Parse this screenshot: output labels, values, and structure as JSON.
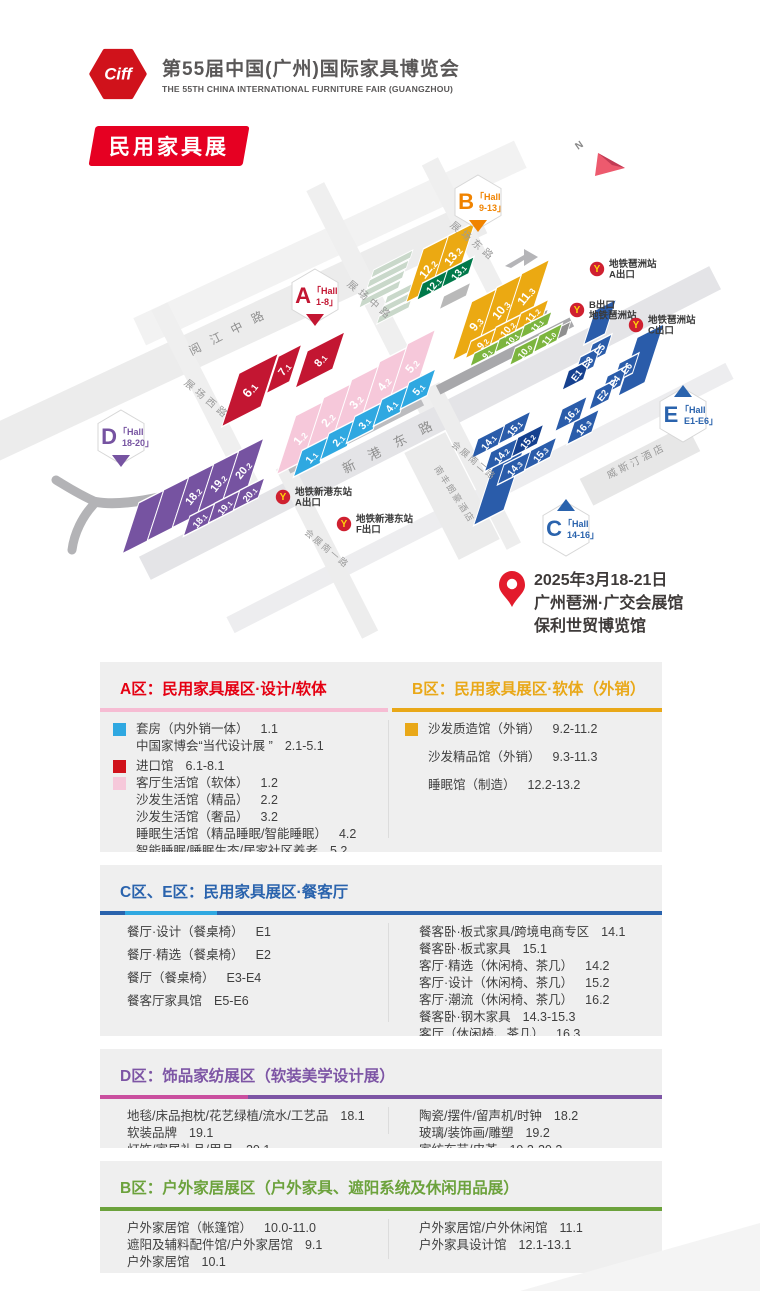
{
  "header": {
    "logo_text": "Ciff",
    "title": "第55届中国(广州)国际家具博览会",
    "subtitle": "THE 55TH CHINA INTERNATIONAL FURNITURE FAIR (GUANGZHOU)"
  },
  "badge": {
    "label": "民用家具展"
  },
  "date_block": {
    "line1": "2025年3月18-21日",
    "line2": "广州琶洲·广交会展馆",
    "line3": "保利世贸博览馆"
  },
  "map": {
    "north_label": "N",
    "roads": [
      {
        "x": 235,
        "y": 193,
        "len": 540,
        "w": 36,
        "angle": -25,
        "color": "#ececec"
      },
      {
        "x": 330,
        "y": 105,
        "len": 420,
        "w": 30,
        "angle": -25,
        "color": "#f2f2f2"
      },
      {
        "x": 430,
        "y": 285,
        "len": 640,
        "w": 26,
        "angle": -27,
        "color": "#e4e4e7"
      },
      {
        "x": 480,
        "y": 360,
        "len": 560,
        "w": 18,
        "angle": -27,
        "color": "#ededef"
      },
      {
        "x": 372,
        "y": 160,
        "len": 250,
        "w": 20,
        "angle": 63,
        "color": "#efefef"
      },
      {
        "x": 207,
        "y": 262,
        "len": 210,
        "w": 18,
        "angle": 63,
        "color": "#efefef"
      },
      {
        "x": 473,
        "y": 108,
        "len": 190,
        "w": 18,
        "angle": 63,
        "color": "#efefef"
      },
      {
        "x": 327,
        "y": 412,
        "len": 190,
        "w": 18,
        "angle": 63,
        "color": "#ededed"
      },
      {
        "x": 473,
        "y": 328,
        "len": 180,
        "w": 16,
        "angle": 63,
        "color": "#ededed"
      },
      {
        "x": 640,
        "y": 327,
        "len": 120,
        "w": 30,
        "angle": -27,
        "color": "#e7e7e7"
      },
      {
        "x": 452,
        "y": 358,
        "len": 120,
        "w": 46,
        "angle": 63,
        "color": "#ebebeb"
      },
      {
        "x": 505,
        "y": 218,
        "len": 150,
        "w": 10,
        "angle": -27,
        "color": "#a8a8ab"
      },
      {
        "x": 355,
        "y": 297,
        "len": 150,
        "w": 10,
        "angle": -27,
        "color": "#bcbcbf"
      }
    ],
    "decor": [
      {
        "x": 392,
        "y": 126,
        "w": 44,
        "h": 6,
        "c": "#c9d8ca"
      },
      {
        "x": 388,
        "y": 136,
        "w": 44,
        "h": 6,
        "c": "#c9d8ca"
      },
      {
        "x": 384,
        "y": 146,
        "w": 44,
        "h": 6,
        "c": "#c9d8ca"
      },
      {
        "x": 380,
        "y": 156,
        "w": 44,
        "h": 6,
        "c": "#c9d8ca"
      },
      {
        "x": 402,
        "y": 154,
        "w": 36,
        "h": 6,
        "c": "#c9d8ca"
      },
      {
        "x": 398,
        "y": 164,
        "w": 36,
        "h": 6,
        "c": "#c9d8ca"
      },
      {
        "x": 394,
        "y": 174,
        "w": 36,
        "h": 6,
        "c": "#c9d8ca"
      },
      {
        "x": 455,
        "y": 158,
        "w": 30,
        "h": 10,
        "c": "#b9b9b9"
      },
      {
        "x": 530,
        "y": 186,
        "w": 36,
        "h": 10,
        "c": "#9f9f9f"
      },
      {
        "x": 557,
        "y": 196,
        "w": 26,
        "h": 10,
        "c": "#8f8f8f"
      }
    ],
    "blocks": [
      {
        "l": "6.1",
        "x": 250,
        "y": 252,
        "w": 44,
        "h": 40,
        "c": "#c31632",
        "fs": 13
      },
      {
        "l": "7.1",
        "x": 284,
        "y": 231,
        "w": 26,
        "h": 28,
        "c": "#c31632",
        "fs": 11
      },
      {
        "l": "8.1",
        "x": 320,
        "y": 222,
        "w": 42,
        "h": 28,
        "c": "#c31632",
        "fs": 11
      },
      {
        "l": "1.2",
        "x": 300,
        "y": 300,
        "w": 31,
        "h": 44,
        "c": "#f6c8da",
        "fs": 12
      },
      {
        "l": "2.2",
        "x": 328,
        "y": 282,
        "w": 31,
        "h": 44,
        "c": "#f6c8da",
        "fs": 12
      },
      {
        "l": "3.2",
        "x": 356,
        "y": 264,
        "w": 31,
        "h": 44,
        "c": "#f6c8da",
        "fs": 12
      },
      {
        "l": "4.2",
        "x": 384,
        "y": 246,
        "w": 31,
        "h": 44,
        "c": "#f6c8da",
        "fs": 12
      },
      {
        "l": "5.2",
        "x": 412,
        "y": 228,
        "w": 31,
        "h": 44,
        "c": "#f6c8da",
        "fs": 12
      },
      {
        "l": "1.1",
        "x": 311,
        "y": 319,
        "w": 30,
        "h": 20,
        "c": "#2fa8e1",
        "fs": 10.5
      },
      {
        "l": "2.1",
        "x": 338,
        "y": 302,
        "w": 30,
        "h": 20,
        "c": "#2fa8e1",
        "fs": 10.5
      },
      {
        "l": "3.1",
        "x": 364,
        "y": 285,
        "w": 30,
        "h": 20,
        "c": "#2fa8e1",
        "fs": 10.5
      },
      {
        "l": "4.1",
        "x": 391,
        "y": 268,
        "w": 30,
        "h": 20,
        "c": "#2fa8e1",
        "fs": 10.5
      },
      {
        "l": "5.1",
        "x": 418,
        "y": 251,
        "w": 30,
        "h": 20,
        "c": "#2fa8e1",
        "fs": 10.5
      },
      {
        "l": "",
        "x": 143,
        "y": 384,
        "w": 28,
        "h": 38,
        "c": "#7653a1"
      },
      {
        "l": "",
        "x": 168,
        "y": 371,
        "w": 28,
        "h": 38,
        "c": "#7653a1"
      },
      {
        "l": "18.2",
        "x": 193,
        "y": 358,
        "w": 28,
        "h": 38,
        "c": "#7653a1",
        "fs": 11
      },
      {
        "l": "19.2",
        "x": 218,
        "y": 345,
        "w": 28,
        "h": 38,
        "c": "#7653a1",
        "fs": 11
      },
      {
        "l": "20.2",
        "x": 243,
        "y": 332,
        "w": 28,
        "h": 38,
        "c": "#7653a1",
        "fs": 11
      },
      {
        "l": "18.1",
        "x": 199,
        "y": 382,
        "w": 28,
        "h": 15,
        "c": "#7653a1",
        "fs": 9.5
      },
      {
        "l": "19.1",
        "x": 224,
        "y": 369,
        "w": 28,
        "h": 15,
        "c": "#7653a1",
        "fs": 9.5
      },
      {
        "l": "20.1",
        "x": 249,
        "y": 356,
        "w": 28,
        "h": 15,
        "c": "#7653a1",
        "fs": 9.5
      },
      {
        "l": "12.2",
        "x": 428,
        "y": 131,
        "w": 30,
        "h": 40,
        "c": "#eba912",
        "fs": 12
      },
      {
        "l": "13.2",
        "x": 453,
        "y": 118,
        "w": 30,
        "h": 40,
        "c": "#eba912",
        "fs": 12
      },
      {
        "l": "12.1",
        "x": 433,
        "y": 147,
        "w": 30,
        "h": 13,
        "c": "#00794a",
        "fs": 10
      },
      {
        "l": "13.1",
        "x": 458,
        "y": 134,
        "w": 30,
        "h": 13,
        "c": "#00794a",
        "fs": 10
      },
      {
        "l": "9.3",
        "x": 476,
        "y": 186,
        "w": 31,
        "h": 44,
        "c": "#eba912",
        "fs": 12
      },
      {
        "l": "10.3",
        "x": 501,
        "y": 172,
        "w": 31,
        "h": 44,
        "c": "#eba912",
        "fs": 12
      },
      {
        "l": "11.3",
        "x": 526,
        "y": 158,
        "w": 31,
        "h": 44,
        "c": "#eba912",
        "fs": 12
      },
      {
        "l": "9.2",
        "x": 482,
        "y": 205,
        "w": 31,
        "h": 13,
        "c": "#eba912",
        "fs": 10
      },
      {
        "l": "10.2",
        "x": 507,
        "y": 191,
        "w": 31,
        "h": 13,
        "c": "#eba912",
        "fs": 10
      },
      {
        "l": "11.2",
        "x": 532,
        "y": 177,
        "w": 31,
        "h": 13,
        "c": "#eba912",
        "fs": 10
      },
      {
        "l": "9.1",
        "x": 486,
        "y": 215,
        "w": 31,
        "h": 10,
        "c": "#7cb53e",
        "fs": 8.5
      },
      {
        "l": "10.1",
        "x": 511,
        "y": 201,
        "w": 31,
        "h": 10,
        "c": "#7cb53e",
        "fs": 8.5
      },
      {
        "l": "11.1",
        "x": 536,
        "y": 187,
        "w": 31,
        "h": 10,
        "c": "#7cb53e",
        "fs": 8.5
      },
      {
        "l": "10.0",
        "x": 524,
        "y": 213,
        "w": 26,
        "h": 13,
        "c": "#7cb53e",
        "fs": 9.5
      },
      {
        "l": "11.0",
        "x": 548,
        "y": 200,
        "w": 26,
        "h": 13,
        "c": "#7cb53e",
        "fs": 9.5
      },
      {
        "l": "",
        "x": 641,
        "y": 222,
        "w": 30,
        "h": 44,
        "c": "#2a5caa"
      },
      {
        "l": "",
        "x": 600,
        "y": 184,
        "w": 24,
        "h": 26,
        "c": "#2a5caa"
      },
      {
        "l": "E5",
        "x": 599,
        "y": 211,
        "w": 22,
        "h": 15,
        "c": "#2a5caa",
        "fs": 9.5
      },
      {
        "l": "E3",
        "x": 587,
        "y": 224,
        "w": 22,
        "h": 15,
        "c": "#2a5caa",
        "fs": 9.5
      },
      {
        "l": "E1",
        "x": 576,
        "y": 237,
        "w": 24,
        "h": 15,
        "c": "#16418f",
        "fs": 9.5
      },
      {
        "l": "E6",
        "x": 626,
        "y": 230,
        "w": 22,
        "h": 15,
        "c": "#2a5caa",
        "fs": 9.5
      },
      {
        "l": "E4",
        "x": 614,
        "y": 243,
        "w": 22,
        "h": 15,
        "c": "#2a5caa",
        "fs": 9.5
      },
      {
        "l": "E2",
        "x": 602,
        "y": 257,
        "w": 22,
        "h": 15,
        "c": "#2a5caa",
        "fs": 9.5
      },
      {
        "l": "16.2",
        "x": 571,
        "y": 276,
        "w": 28,
        "h": 17,
        "c": "#2a5caa",
        "fs": 10
      },
      {
        "l": "16.3",
        "x": 583,
        "y": 289,
        "w": 28,
        "h": 17,
        "c": "#2a5caa",
        "fs": 10
      },
      {
        "l": "",
        "x": 500,
        "y": 345,
        "w": 34,
        "h": 52,
        "c": "#2a5caa"
      },
      {
        "l": "15.1",
        "x": 514,
        "y": 290,
        "w": 30,
        "h": 15,
        "c": "#2a5caa",
        "fs": 10
      },
      {
        "l": "14.1",
        "x": 488,
        "y": 304,
        "w": 30,
        "h": 15,
        "c": "#2a5caa",
        "fs": 10
      },
      {
        "l": "15.2",
        "x": 527,
        "y": 303,
        "w": 30,
        "h": 15,
        "c": "#16418f",
        "fs": 10
      },
      {
        "l": "14.2",
        "x": 501,
        "y": 317,
        "w": 30,
        "h": 15,
        "c": "#2a5caa",
        "fs": 10
      },
      {
        "l": "15.3",
        "x": 540,
        "y": 316,
        "w": 30,
        "h": 15,
        "c": "#2a5caa",
        "fs": 10
      },
      {
        "l": "14.3",
        "x": 514,
        "y": 330,
        "w": 30,
        "h": 15,
        "c": "#2a5caa",
        "fs": 10
      }
    ],
    "road_labels": [
      {
        "text": "阅 江 中 路",
        "x": 230,
        "y": 198,
        "angle": -27,
        "ls": 4,
        "fs": 12,
        "color": "#8f8f8f"
      },
      {
        "text": "新 港 东 路",
        "x": 392,
        "y": 312,
        "angle": -27,
        "ls": 6,
        "fs": 13,
        "color": "#8f8f8f"
      },
      {
        "text": "展场中路",
        "x": 368,
        "y": 165,
        "angle": 40,
        "ls": 4,
        "fs": 10,
        "color": "#9b9b9b"
      },
      {
        "text": "展场西路",
        "x": 205,
        "y": 264,
        "angle": 40,
        "ls": 4,
        "fs": 10,
        "color": "#9b9b9b"
      },
      {
        "text": "展场东路",
        "x": 471,
        "y": 106,
        "angle": 40,
        "ls": 4,
        "fs": 10,
        "color": "#9b9b9b"
      },
      {
        "text": "会展南一路",
        "x": 325,
        "y": 413,
        "angle": 40,
        "ls": 2,
        "fs": 9,
        "color": "#9b9b9b"
      },
      {
        "text": "会展南二路",
        "x": 472,
        "y": 325,
        "angle": 40,
        "ls": 2,
        "fs": 9,
        "color": "#9b9b9b"
      },
      {
        "text": "威斯汀酒店",
        "x": 638,
        "y": 326,
        "angle": -27,
        "ls": 3,
        "fs": 10,
        "color": "#9a9a9a"
      },
      {
        "text": "南丰朗豪酒店",
        "x": 452,
        "y": 358,
        "angle": 57,
        "ls": 2,
        "fs": 9,
        "color": "#9a9a9a"
      }
    ],
    "metro": [
      {
        "x": 597,
        "y": 131,
        "lines": [
          "地铁琶洲站",
          "A出口"
        ]
      },
      {
        "x": 577,
        "y": 172,
        "lines": [
          "B出口",
          "地铁琶洲站"
        ]
      },
      {
        "x": 636,
        "y": 187,
        "lines": [
          "地铁琶洲站",
          "C出口"
        ]
      },
      {
        "x": 283,
        "y": 359,
        "lines": [
          "地铁新港东站",
          "A出口"
        ]
      },
      {
        "x": 344,
        "y": 386,
        "lines": [
          "地铁新港东站",
          "F出口"
        ]
      }
    ],
    "hall_badges": [
      {
        "letter": "A",
        "l1": "「Hall",
        "l2": "1-8」",
        "x": 315,
        "y": 158,
        "c": "#c31632",
        "tip": "down"
      },
      {
        "letter": "B",
        "l1": "「Hall",
        "l2": "9-13」",
        "x": 478,
        "y": 64,
        "c": "#f08300",
        "tip": "down"
      },
      {
        "letter": "D",
        "l1": "「Hall",
        "l2": "18-20」",
        "x": 121,
        "y": 299,
        "c": "#7653a1",
        "tip": "down"
      },
      {
        "letter": "E",
        "l1": "「Hall",
        "l2": "E1-E6」",
        "x": 683,
        "y": 277,
        "c": "#2a63ad",
        "tip": "up"
      },
      {
        "letter": "C",
        "l1": "「Hall",
        "l2": "14-16」",
        "x": 566,
        "y": 391,
        "c": "#2a63ad",
        "tip": "up"
      }
    ]
  },
  "sections": [
    {
      "h": 190,
      "columns": [
        {
          "header": "A区：民用家具展区·设计/软体",
          "hcolor": "#e50012",
          "underline": [
            [
              "#f6bcd3",
              0
            ]
          ],
          "pitch": "dense",
          "items": [
            {
              "sw": "#2fa8e1",
              "label": "套房（内外销一体）",
              "num": "1.1"
            },
            {
              "label": "中国家博会“当代设计展 ”",
              "num": "2.1-5.1"
            },
            {
              "sw": "#d0121b",
              "label": "进口馆",
              "num": "6.1-8.1",
              "gap": true
            },
            {
              "sw": "#f6c8da",
              "label": "客厅生活馆（软体）",
              "num": "1.2"
            },
            {
              "label": "沙发生活馆（精品）",
              "num": "2.2"
            },
            {
              "label": "沙发生活馆（奢品）",
              "num": "3.2"
            },
            {
              "label": "睡眠生活馆（精品睡眠/智能睡眠）",
              "num": "4.2"
            },
            {
              "label": "智能睡眠/睡眠生态/居家社区养老",
              "num": "5.2"
            }
          ]
        },
        {
          "header": "B区：民用家具展区·软体（外销）",
          "hcolor": "#e9a818",
          "underline": [
            [
              "#e9a818",
              0
            ]
          ],
          "pitch": "loose",
          "items": [
            {
              "sw": "#e9a818",
              "label": "沙发质造馆（外销）",
              "num": "9.2-11.2"
            },
            {
              "label": "沙发精品馆（外销）",
              "num": "9.3-11.3"
            },
            {
              "label": "睡眠馆（制造）",
              "num": "12.2-13.2"
            }
          ]
        }
      ]
    },
    {
      "h": 171,
      "header": "C区、E区：民用家具展区·餐客厅",
      "hcolor": "#2a63ad",
      "underline": [
        [
          "#2a63ad",
          25
        ],
        [
          "#2fa8e1",
          92
        ],
        [
          "#2a63ad",
          0
        ]
      ],
      "columns": [
        {
          "pitch": "mid",
          "items": [
            {
              "label": "餐厅·设计（餐桌椅）",
              "num": "E1"
            },
            {
              "label": "餐厅·精选（餐桌椅）",
              "num": "E2"
            },
            {
              "label": "餐厅（餐桌椅）",
              "num": "E3-E4"
            },
            {
              "label": "餐客厅家具馆",
              "num": "E5-E6"
            }
          ]
        },
        {
          "pitch": "dense",
          "items": [
            {
              "label": "餐客卧·板式家具/跨境电商专区",
              "num": "14.1"
            },
            {
              "label": "餐客卧·板式家具",
              "num": "15.1"
            },
            {
              "label": "客厅·精选（休闲椅、茶几）",
              "num": "14.2"
            },
            {
              "label": "客厅·设计（休闲椅、茶几）",
              "num": "15.2"
            },
            {
              "label": "客厅·潮流（休闲椅、茶几）",
              "num": "16.2"
            },
            {
              "label": "餐客卧·钢木家具",
              "num": "14.3-15.3"
            },
            {
              "label": "客厅（休闲椅、茶几）",
              "num": "16.3"
            }
          ]
        }
      ]
    },
    {
      "h": 99,
      "header": "D区：饰品家纺展区（软装美学设计展）",
      "hcolor": "#7d55a5",
      "underline": [
        [
          "#ca4f9f",
          148
        ],
        [
          "#7d55a5",
          0
        ]
      ],
      "columns": [
        {
          "pitch": "dense",
          "items": [
            {
              "label": "地毯/床品抱枕/花艺绿植/流水/工艺品",
              "num": "18.1"
            },
            {
              "label": "软装品牌",
              "num": "19.1"
            },
            {
              "label": "灯饰/家居礼品/用品",
              "num": "20.1"
            }
          ]
        },
        {
          "pitch": "dense",
          "items": [
            {
              "label": "陶瓷/摆件/留声机/时钟",
              "num": "18.2"
            },
            {
              "label": "玻璃/装饰画/雕塑",
              "num": "19.2"
            },
            {
              "label": "家纺布艺/皮革",
              "num": "19.2-20.2"
            }
          ]
        }
      ]
    },
    {
      "h": 112,
      "header": "B区：户外家居展区（户外家具、遮阳系统及休闲用品展）",
      "hcolor": "#6ca23c",
      "underline": [
        [
          "#6ca23c",
          0
        ]
      ],
      "columns": [
        {
          "pitch": "dense",
          "items": [
            {
              "label": "户外家居馆（帐篷馆）",
              "num": "10.0-11.0"
            },
            {
              "label": "遮阳及辅料配件馆/户外家居馆",
              "num": "9.1"
            },
            {
              "label": "户外家居馆",
              "num": "10.1"
            }
          ]
        },
        {
          "pitch": "dense",
          "items": [
            {
              "label": "户外家居馆/户外休闲馆",
              "num": "11.1"
            },
            {
              "label": "户外家具设计馆",
              "num": "12.1-13.1"
            }
          ]
        }
      ]
    }
  ]
}
